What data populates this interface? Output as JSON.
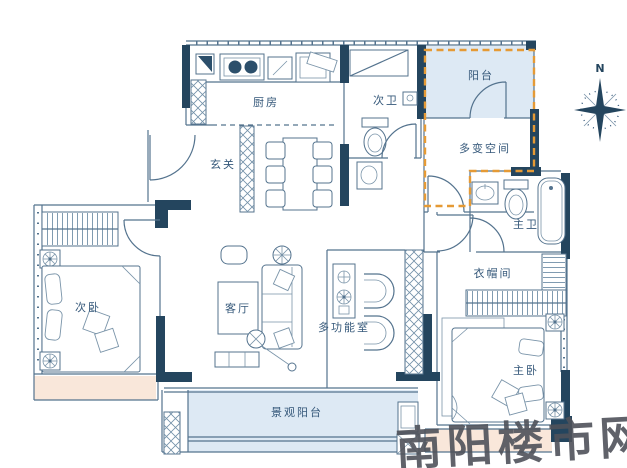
{
  "plan_rooms": {
    "kitchen": "厨房",
    "second_bath": "次卫",
    "balcony": "阳台",
    "flex_space": "多变空间",
    "foyer": "玄关",
    "master_bath": "主卫",
    "second_bedroom": "次卧",
    "living_room": "客厅",
    "multi_room": "多功能室",
    "cloakroom": "衣帽间",
    "master_bedroom": "主卧",
    "view_balcony": "景观阳台"
  },
  "compass": {
    "north_label": "N"
  },
  "watermark": {
    "text": "南阳楼市网"
  },
  "colors": {
    "wall": "#24455e",
    "line": "#54738e",
    "balcony_fill": "#dde9f4",
    "bay_window_fill": "#f9e7da",
    "highlight_dashed": "#e59a35",
    "label_text": "#35587a",
    "watermark_text": "#4f525a",
    "background": "#ffffff"
  }
}
